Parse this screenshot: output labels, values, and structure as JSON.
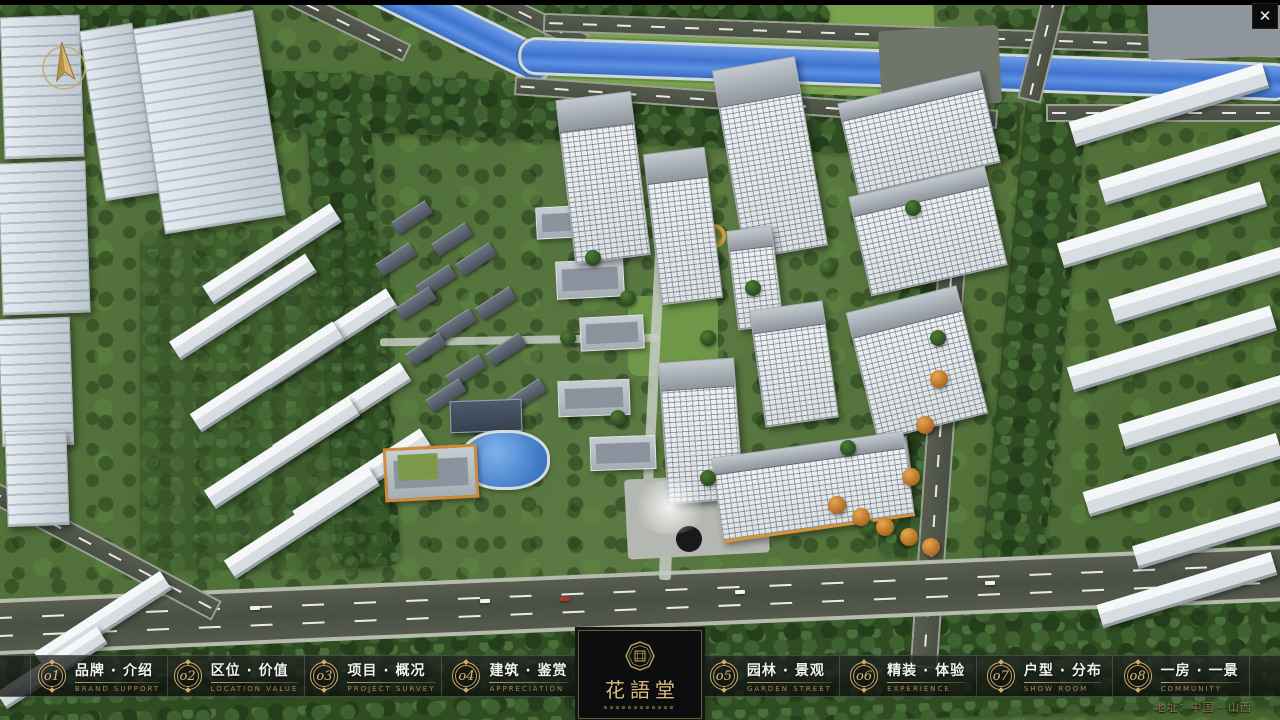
{
  "colors": {
    "accent_gold": "#c9a96a",
    "river_blue": "#4a7fd6",
    "navbar_bg": "rgba(12,14,14,0.78)"
  },
  "window": {
    "close_glyph": "✕"
  },
  "nav": {
    "items": [
      {
        "num": "o1",
        "label": "品牌 · 介绍",
        "caption": "BRAND SUPPORT"
      },
      {
        "num": "o2",
        "label": "区位 · 价值",
        "caption": "LOCATION VALUE"
      },
      {
        "num": "o3",
        "label": "项目 · 概况",
        "caption": "PROJECT SURVEY"
      },
      {
        "num": "o4",
        "label": "建筑 · 鉴赏",
        "caption": "APPRECIATION"
      },
      {
        "num": "o5",
        "label": "园林 · 景观",
        "caption": "GARDEN STREET"
      },
      {
        "num": "o6",
        "label": "精装 · 体验",
        "caption": "EXPERIENCE"
      },
      {
        "num": "o7",
        "label": "户型 · 分布",
        "caption": "SHOW ROOM"
      },
      {
        "num": "o8",
        "label": "一房 · 一景",
        "caption": "COMMUNITY"
      }
    ]
  },
  "logo": {
    "title": "花語堂"
  },
  "footer": {
    "address": "地址：中国 · 山西"
  }
}
